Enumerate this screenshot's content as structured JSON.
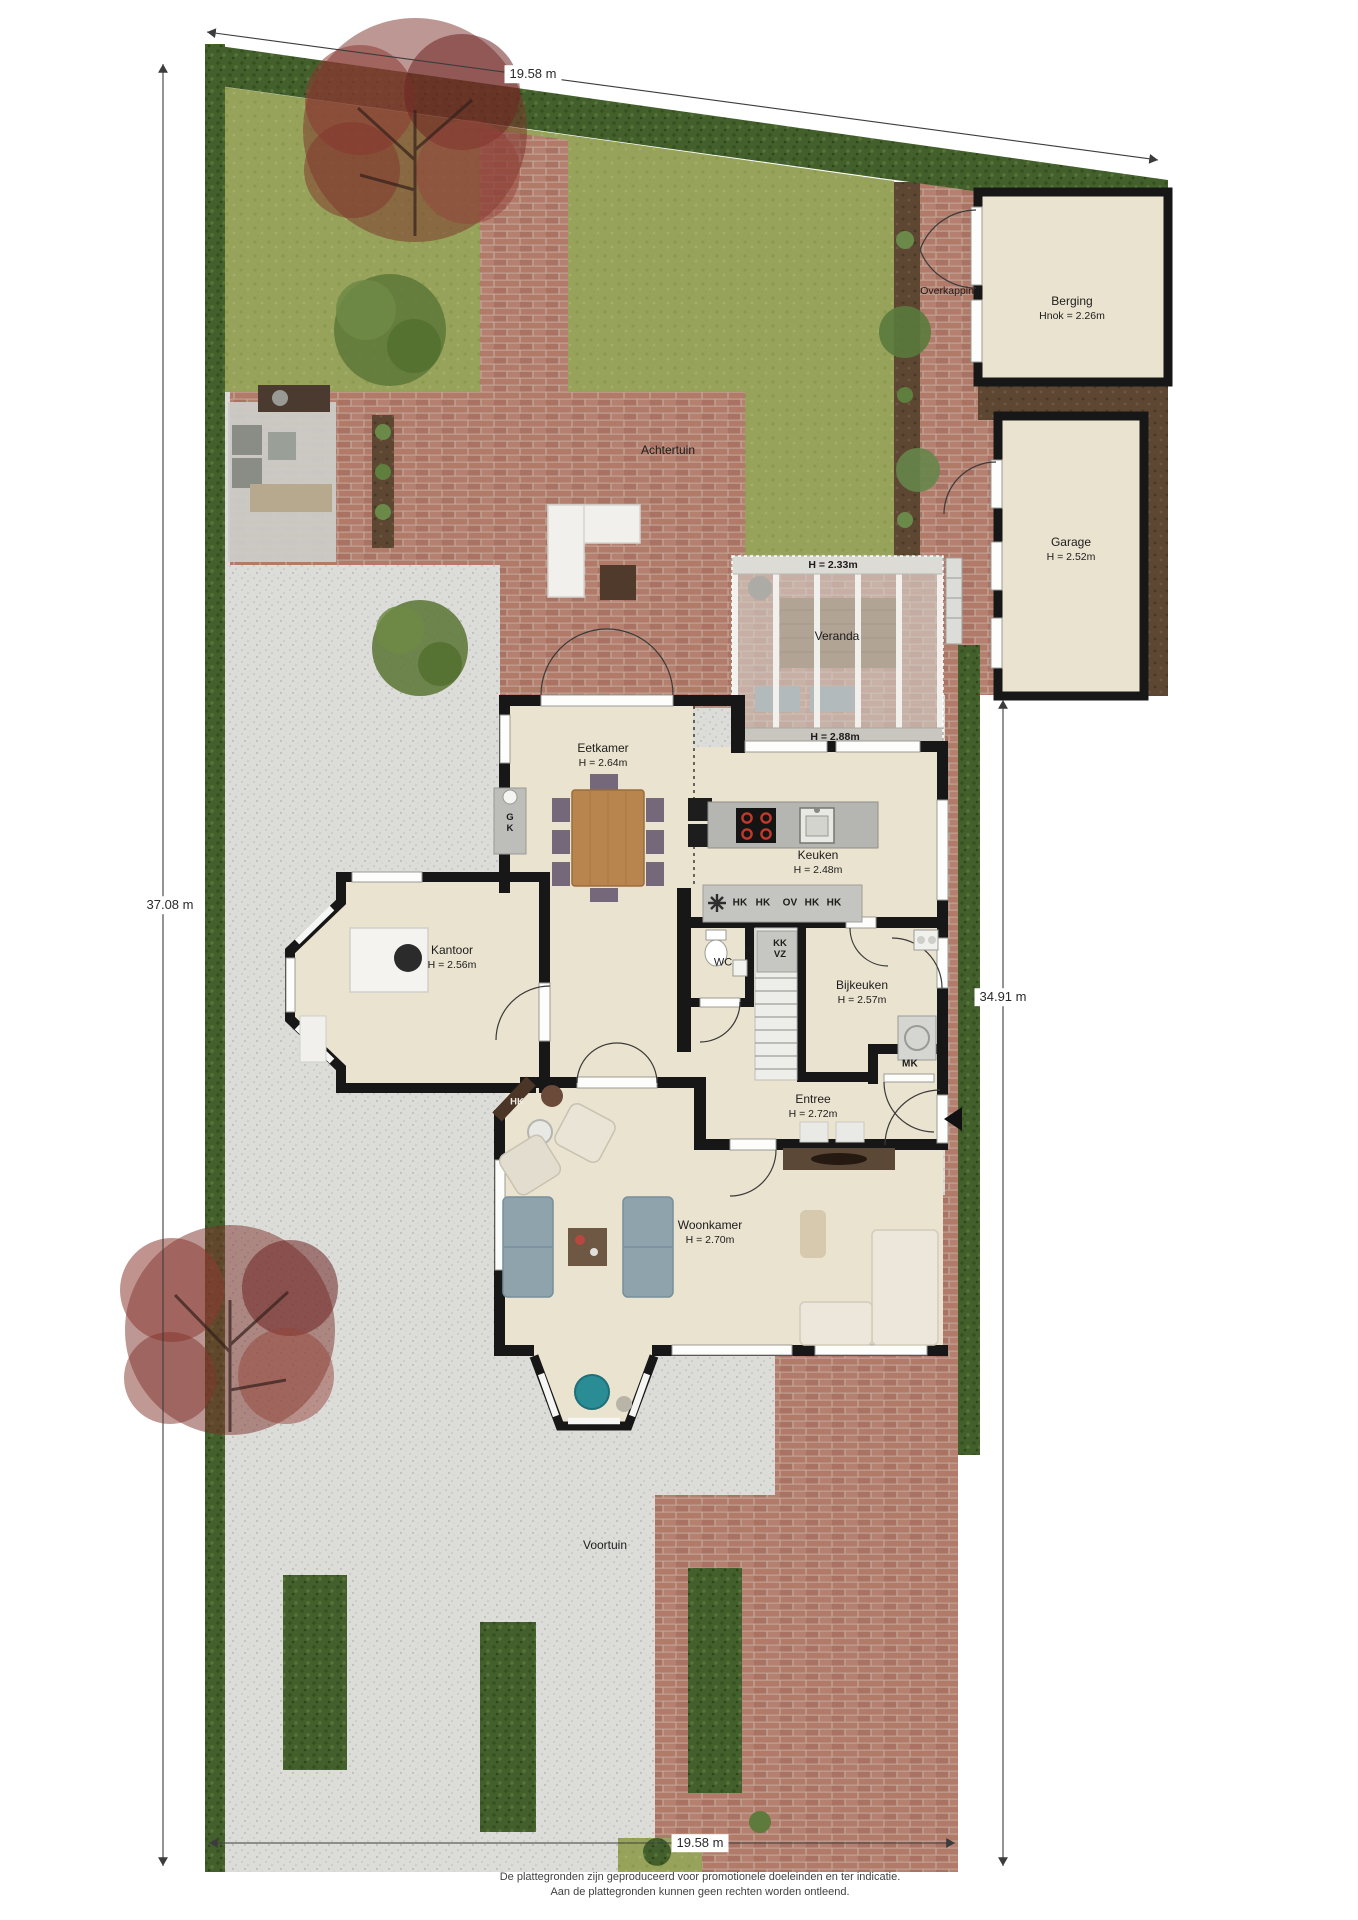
{
  "dimensions": {
    "top": "19.58 m",
    "bottom": "19.58 m",
    "left": "37.08 m",
    "right": "34.91 m"
  },
  "outdoor": {
    "back_garden": "Achtertuin",
    "front_garden": "Voortuin",
    "canopy": "Overkapping"
  },
  "rooms": {
    "berging": {
      "name": "Berging",
      "height": "Hnok = 2.26m"
    },
    "garage": {
      "name": "Garage",
      "height": "H = 2.52m"
    },
    "veranda": {
      "name": "Veranda",
      "height_top": "H = 2.33m",
      "height_bottom": "H = 2.88m"
    },
    "eetkamer": {
      "name": "Eetkamer",
      "height": "H = 2.64m"
    },
    "keuken": {
      "name": "Keuken",
      "height": "H = 2.48m"
    },
    "kantoor": {
      "name": "Kantoor",
      "height": "H = 2.56m"
    },
    "wc": {
      "name": "WC"
    },
    "bijkeuken": {
      "name": "Bijkeuken",
      "height": "H = 2.57m"
    },
    "entree": {
      "name": "Entree",
      "height": "H = 2.72m"
    },
    "woonkamer": {
      "name": "Woonkamer",
      "height": "H = 2.70m"
    }
  },
  "fixtures": {
    "counter_top": "G",
    "counter_bottom": "K",
    "kitchen_units": [
      "HK",
      "HK",
      "OV",
      "HK",
      "HK"
    ],
    "closet_k": "K",
    "closet_kk": "KK",
    "closet_vz": "VZ",
    "meter_closet": "MK",
    "fireplace": "HK"
  },
  "footer": {
    "line1": "De plattegronden zijn geproduceerd voor promotionele doeleinden en ter indicatie.",
    "line2": "Aan de plattegronden kunnen geen rechten worden ontleend."
  },
  "colors": {
    "hedge": "#43602c",
    "lawn": "#97a35a",
    "brick": "#b27a69",
    "gravel": "#dcdcd9",
    "soil": "#5d4733",
    "floor": "#eae3cf",
    "wall": "#171717",
    "glass": "#cbc8c1",
    "tree_red": "#7c2f2a",
    "dimension_line": "#3c3c3c"
  }
}
